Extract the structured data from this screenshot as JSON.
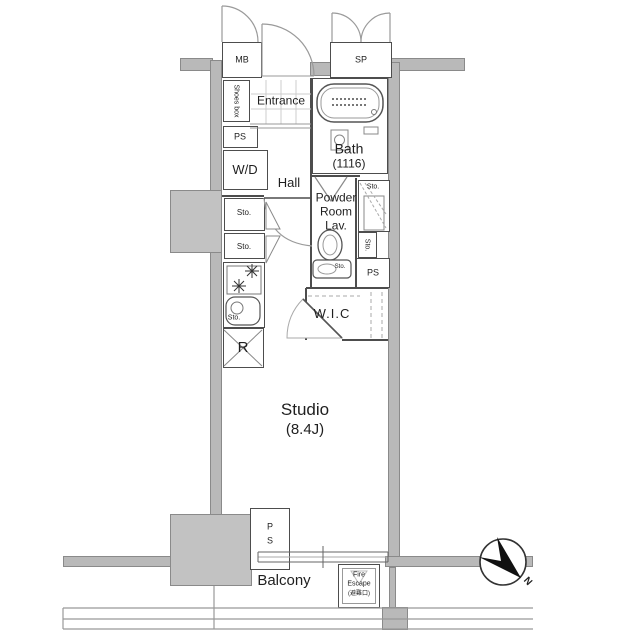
{
  "rooms": {
    "entrance": "Entrance",
    "hall": "Hall",
    "bath": "Bath",
    "bath_size": "(1116)",
    "powder_1": "Powder",
    "powder_2": "Room",
    "powder_3": "Lav.",
    "wic": "W.I.C",
    "studio": "Studio",
    "studio_size": "(8.4J)",
    "balcony": "Balcony"
  },
  "labels": {
    "mb": "MB",
    "sp": "SP",
    "shoes_box": "Shoes box",
    "ps": "PS",
    "wd": "W/D",
    "sto": "Sto.",
    "r": "R",
    "p": "P",
    "s": "S"
  },
  "fire_escape": {
    "line1": "Fire",
    "line2": "Escape",
    "line3": "(避難口)"
  },
  "compass": {
    "north": "N"
  },
  "colors": {
    "wall_fill": "#b9b9b9",
    "wall_edge": "#8a8a8a",
    "line_dark": "#4d4d4d",
    "text": "#1f1f1f"
  }
}
